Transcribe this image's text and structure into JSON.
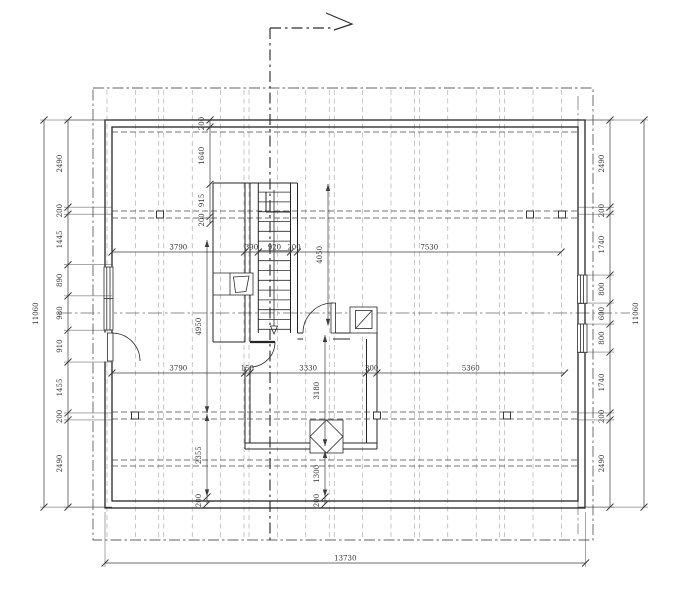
{
  "drawing": {
    "type": "architectural-floor-plan",
    "units": "mm",
    "scale_px_per_mm": 0.035,
    "line_color": "#252525",
    "dim_color": "#3c3c3c",
    "overall_width": "13730",
    "overall_height": "11060"
  },
  "dimensions": {
    "chains": [
      {
        "name": "left-overall",
        "orient": "v",
        "line_x": 44,
        "start": 120,
        "values": [
          "11060"
        ],
        "label_side": -1,
        "ext_to": 112
      },
      {
        "name": "left-chain",
        "orient": "v",
        "line_x": 68,
        "start": 120,
        "values": [
          "2490",
          "200",
          "1445",
          "890",
          "980",
          "910",
          "1455",
          "200",
          "2490"
        ],
        "label_side": -1,
        "ext_to": 112
      },
      {
        "name": "right-chain",
        "orient": "v",
        "line_x": 610,
        "start": 120,
        "values": [
          "2490",
          "200",
          "1740",
          "800",
          "600",
          "800",
          "1740",
          "200",
          "2490"
        ],
        "label_side": -1,
        "ext_to": 578
      },
      {
        "name": "right-overall",
        "orient": "v",
        "line_x": 644,
        "start": 120,
        "values": [
          "11060"
        ],
        "label_side": -1,
        "ext_to": 578
      },
      {
        "name": "bottom-overall",
        "orient": "h",
        "line_y": 563,
        "start": 105,
        "values": [
          "13730"
        ],
        "label_side": -1,
        "ext_to": 512
      },
      {
        "name": "row-upper",
        "orient": "h",
        "line_y": 252,
        "start": 112,
        "values": [
          "3790",
          "390",
          "920",
          "200",
          "7530"
        ],
        "label_side": -1
      },
      {
        "name": "row-lower",
        "orient": "h",
        "line_y": 373,
        "start": 112,
        "values": [
          "3790",
          "150",
          "3330",
          "300",
          "5360"
        ],
        "label_side": -1
      },
      {
        "name": "stair-top-chain",
        "orient": "v",
        "line_x": 210,
        "start": 120,
        "values": [
          "200",
          "1640",
          "915",
          "200"
        ],
        "label_side": -1
      },
      {
        "name": "stair-depth",
        "orient": "v",
        "line_x": 328,
        "start": 184,
        "values": [
          "4050"
        ],
        "label_side": -1,
        "arrows": true
      },
      {
        "name": "left-mid-room",
        "orient": "v",
        "line_x": 207,
        "start": 240,
        "values": [
          "4950"
        ],
        "label_side": -1,
        "arrows": true
      },
      {
        "name": "mid-room-depth",
        "orient": "v",
        "line_x": 325,
        "start": 335,
        "values": [
          "3180"
        ],
        "label_side": -1,
        "arrows": true
      },
      {
        "name": "left-lower-room",
        "orient": "v",
        "line_x": 207,
        "start": 414,
        "values": [
          "2355"
        ],
        "label_side": -1,
        "arrows": true
      },
      {
        "name": "chimney-offset",
        "orient": "v",
        "line_x": 325,
        "start": 451,
        "values": [
          "1300"
        ],
        "label_side": -1,
        "arrows": true
      },
      {
        "name": "wall-thickness-left",
        "orient": "v",
        "line_x": 207,
        "start": 497,
        "values": [
          "200"
        ],
        "label_side": -1
      },
      {
        "name": "wall-thickness-mid",
        "orient": "v",
        "line_x": 325,
        "start": 497,
        "values": [
          "200"
        ],
        "label_side": -1
      }
    ]
  }
}
